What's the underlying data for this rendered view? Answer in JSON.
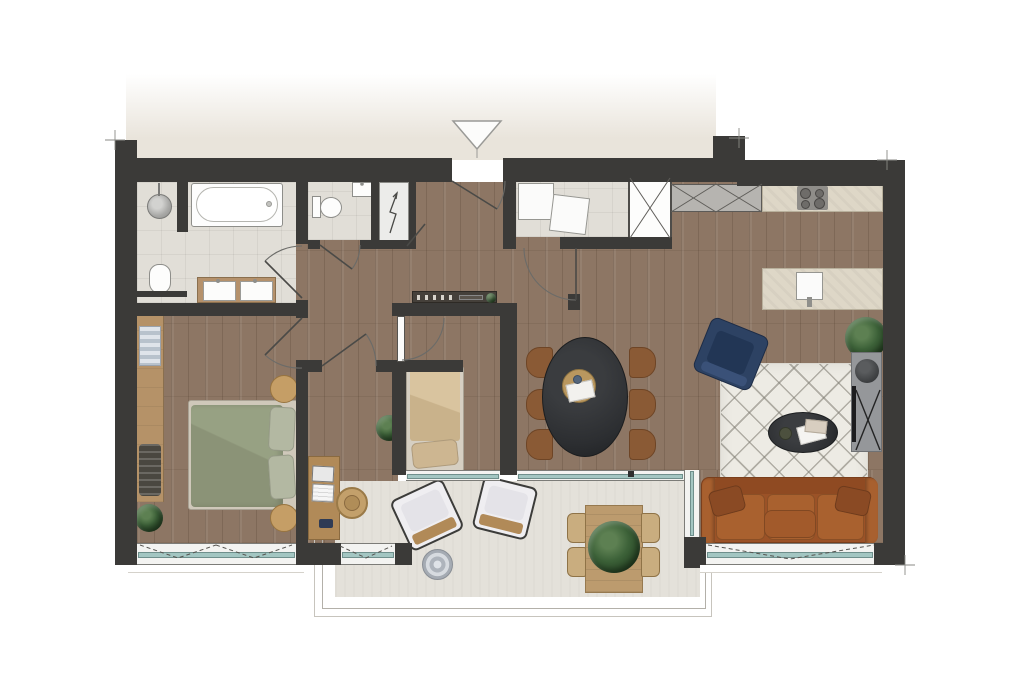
{
  "meta": {
    "type": "architectural-floor-plan",
    "view": "top-down-render",
    "text_labels": [],
    "entry_marker": "triangle-down"
  },
  "palette": {
    "wall": "#3b3a38",
    "wood_floor": "#8d7664",
    "tile_floor": "#e1ded7",
    "terrace_floor": "#e4e1da",
    "exterior_band": "#e9e4db",
    "glass": "#a3c6c2",
    "frame": "#7c7c78",
    "counter": "#ded7c7",
    "units_gray": "#b6b4b0",
    "rug": "#edebe4",
    "sofa": "#9b5227",
    "armchair": "#2d4263",
    "bed_green": "#97a183",
    "bed_beige": "#d9c49f",
    "dining_table": "#2c2e31",
    "chair_wood": "#8a5a35",
    "furniture_wood": "#b18a58",
    "plant": "#3c6138",
    "white_fixture": "#fbfbfa",
    "line": "#6b6b68"
  },
  "rooms": [
    {
      "name": "bathroom",
      "floor": "tile",
      "fixtures": [
        "walk-in-shower",
        "rain-shower-head",
        "bathtub",
        "wall-hung-toilet",
        "double-vanity"
      ]
    },
    {
      "name": "wc",
      "floor": "tile",
      "fixtures": [
        "toilet",
        "hand-basin"
      ]
    },
    {
      "name": "technical-shaft",
      "floor": "tile",
      "symbol": "electrical-riser-arrow"
    },
    {
      "name": "laundry-room",
      "floor": "tile",
      "fixtures": [
        "washing-machine",
        "dryer"
      ]
    },
    {
      "name": "hallway",
      "floor": "wood",
      "furniture": [
        "console-sideboard",
        "candlesticks",
        "small-plant"
      ]
    },
    {
      "name": "kitchen-living-dining",
      "floor": "wood",
      "furniture": [
        "tall-cabinet-row",
        "counter-with-cooktop",
        "kitchen-island-with-sink",
        "built-in-closet",
        "oval-dining-table",
        "dining-chairs",
        "blue-armchair",
        "diamond-rug",
        "oval-coffee-table",
        "tv-sideboard",
        "leather-sofa",
        "plant"
      ]
    },
    {
      "name": "master-bedroom",
      "floor": "wood",
      "furniture": [
        "double-bed",
        "round-nightstand-top",
        "round-nightstand-bottom",
        "open-wardrobe",
        "plant"
      ]
    },
    {
      "name": "bedroom-2",
      "floor": "wood",
      "furniture": [
        "single-bed"
      ]
    },
    {
      "name": "study",
      "floor": "wood",
      "furniture": [
        "desk",
        "laptop",
        "phone",
        "rattan-chair",
        "plant"
      ]
    },
    {
      "name": "terrace",
      "floor": "concrete",
      "furniture": [
        "lounge-chair-1",
        "lounge-chair-2",
        "round-side-table",
        "outdoor-dining-table",
        "outdoor-chairs",
        "large-plant"
      ]
    }
  ],
  "symbols": {
    "entry_arrow": "triangle-down",
    "door_swings": 7,
    "casement_window_dashes": 3,
    "closet_x_marks": 3,
    "electrical_riser": "zigzag-arrow",
    "tv_cross_stand": "x-legs"
  },
  "counts": {
    "cooktop_burners": 4,
    "dining_chairs": 6,
    "outdoor_chairs": 4,
    "lounge_chairs": 2,
    "vanity_basins": 2,
    "appliances": 2
  }
}
